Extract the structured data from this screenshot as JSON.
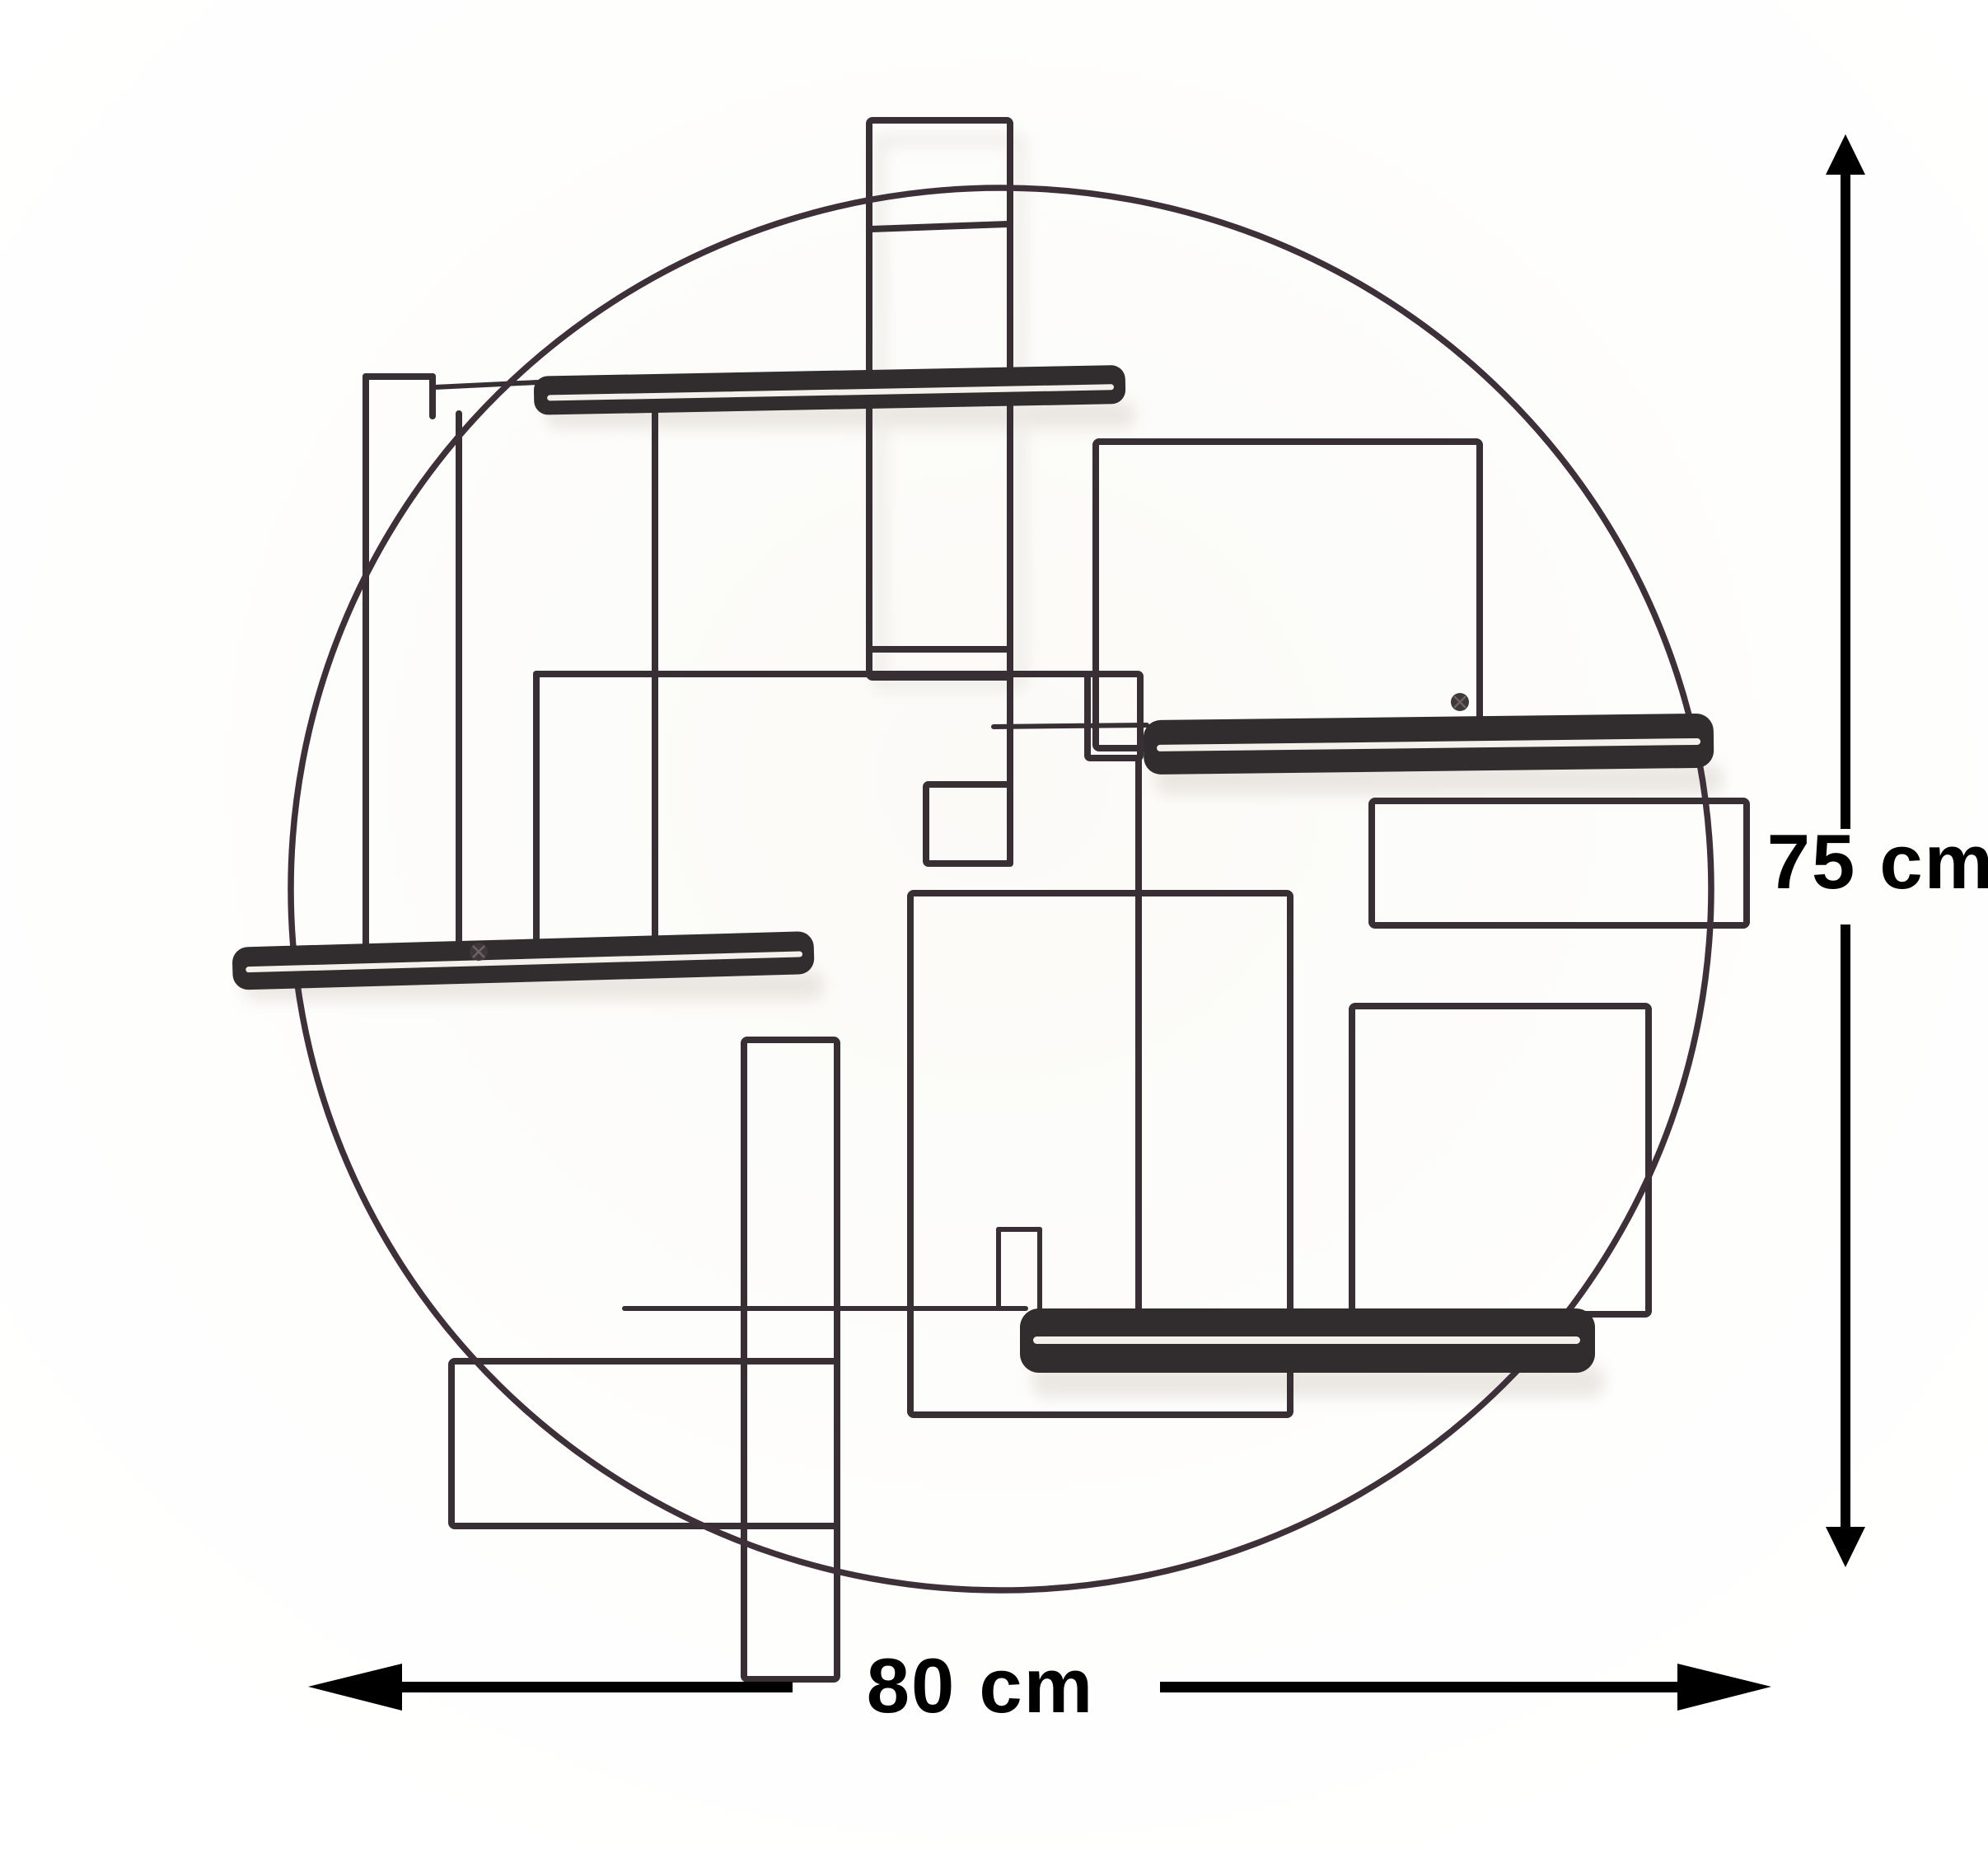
{
  "page": {
    "background": "#ffffff",
    "content_type": "product dimension photo"
  },
  "artwork": {
    "name": "round wire wall shelf",
    "frame_shape": "circle",
    "wire_color": "#382f34",
    "circle_color": "#3d3038",
    "shelf_color": "#312c2e",
    "shelf_slit_color": "#f4f1ec",
    "shelf_count": 4,
    "rectangle_count": 9
  },
  "dimensions": {
    "height": {
      "label": "75 cm",
      "value": 75,
      "unit": "cm"
    },
    "width": {
      "label": "80 cm",
      "value": 80,
      "unit": "cm"
    },
    "arrow_color": "#000000"
  }
}
